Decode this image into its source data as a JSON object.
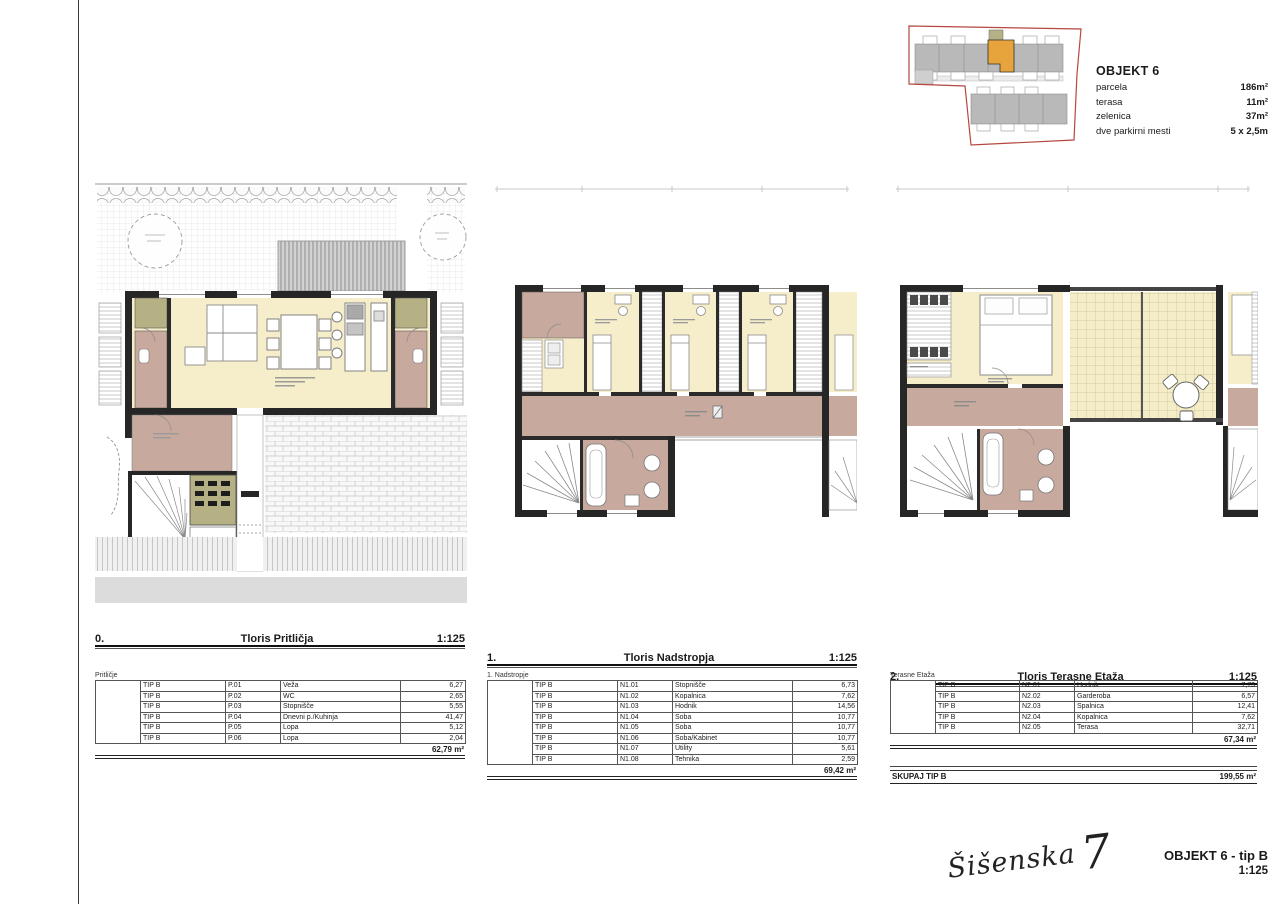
{
  "site_plan": {
    "title": "OBJEKT 6",
    "info": [
      {
        "label": "parcela",
        "value": "186m²"
      },
      {
        "label": "terasa",
        "value": "11m²"
      },
      {
        "label": "zelenica",
        "value": "37m²"
      },
      {
        "label": "dve parkirni mesti",
        "value": "5 x 2,5m"
      }
    ]
  },
  "floor_plans": [
    {
      "num": "0.",
      "title": "Tloris Pritličja",
      "scale": "1:125"
    },
    {
      "num": "1.",
      "title": "Tloris Nadstropja",
      "scale": "1:125"
    },
    {
      "num": "2.",
      "title": "Tloris Terasne Etaža",
      "scale": "1:125"
    }
  ],
  "area_tables": [
    {
      "floor_label": "Pritličje",
      "rows": [
        {
          "tip": "TIP B",
          "code": "P.01",
          "name": "Veža",
          "area": "6,27"
        },
        {
          "tip": "TIP B",
          "code": "P.02",
          "name": "WC",
          "area": "2,65"
        },
        {
          "tip": "TIP B",
          "code": "P.03",
          "name": "Stopnišče",
          "area": "5,55"
        },
        {
          "tip": "TIP B",
          "code": "P.04",
          "name": "Dnevni p./Kuhinja",
          "area": "41,47"
        },
        {
          "tip": "TIP B",
          "code": "P.05",
          "name": "Lopa",
          "area": "5,12"
        },
        {
          "tip": "TIP B",
          "code": "P.06",
          "name": "Lopa",
          "area": "2,04"
        }
      ],
      "total": "62,79 m²"
    },
    {
      "floor_label": "1. Nadstropje",
      "rows": [
        {
          "tip": "TIP B",
          "code": "N1.01",
          "name": "Stopnišče",
          "area": "6,73"
        },
        {
          "tip": "TIP B",
          "code": "N1.02",
          "name": "Kopalnica",
          "area": "7,62"
        },
        {
          "tip": "TIP B",
          "code": "N1.03",
          "name": "Hodnik",
          "area": "14,56"
        },
        {
          "tip": "TIP B",
          "code": "N1.04",
          "name": "Soba",
          "area": "10,77"
        },
        {
          "tip": "TIP B",
          "code": "N1.05",
          "name": "Soba",
          "area": "10,77"
        },
        {
          "tip": "TIP B",
          "code": "N1.06",
          "name": "Soba/Kabinet",
          "area": "10,77"
        },
        {
          "tip": "TIP B",
          "code": "N1.07",
          "name": "Utility",
          "area": "5,61"
        },
        {
          "tip": "TIP B",
          "code": "N1.08",
          "name": "Tehnika",
          "area": "2,59"
        }
      ],
      "total": "69,42 m²"
    },
    {
      "floor_label": "Terasne Etaža",
      "rows": [
        {
          "tip": "TIP B",
          "code": "N2.01",
          "name": "Hodnik",
          "area": "7,73"
        },
        {
          "tip": "TIP B",
          "code": "N2.02",
          "name": "Garderoba",
          "area": "6,57"
        },
        {
          "tip": "TIP B",
          "code": "N2.03",
          "name": "Spalnica",
          "area": "12,41"
        },
        {
          "tip": "TIP B",
          "code": "N2.04",
          "name": "Kopalnica",
          "area": "7,62"
        },
        {
          "tip": "TIP B",
          "code": "N2.05",
          "name": "Terasa",
          "area": "32,71"
        }
      ],
      "total": "67,34 m²"
    }
  ],
  "summary": {
    "label": "SKUPAJ TIP B",
    "value": "199,55 m²"
  },
  "footer": {
    "signature_name": "Šišenska",
    "signature_number": "7",
    "object_label": "OBJEKT 6 - tip B",
    "scale": "1:125"
  },
  "colors": {
    "parcel_red": "#b5473f",
    "highlight_orange": "#e8a43c",
    "room_cream": "#f6eecb",
    "hall_pink": "#c8a99e",
    "storage_olive": "#b5b184",
    "wall_dark": "#262626"
  }
}
